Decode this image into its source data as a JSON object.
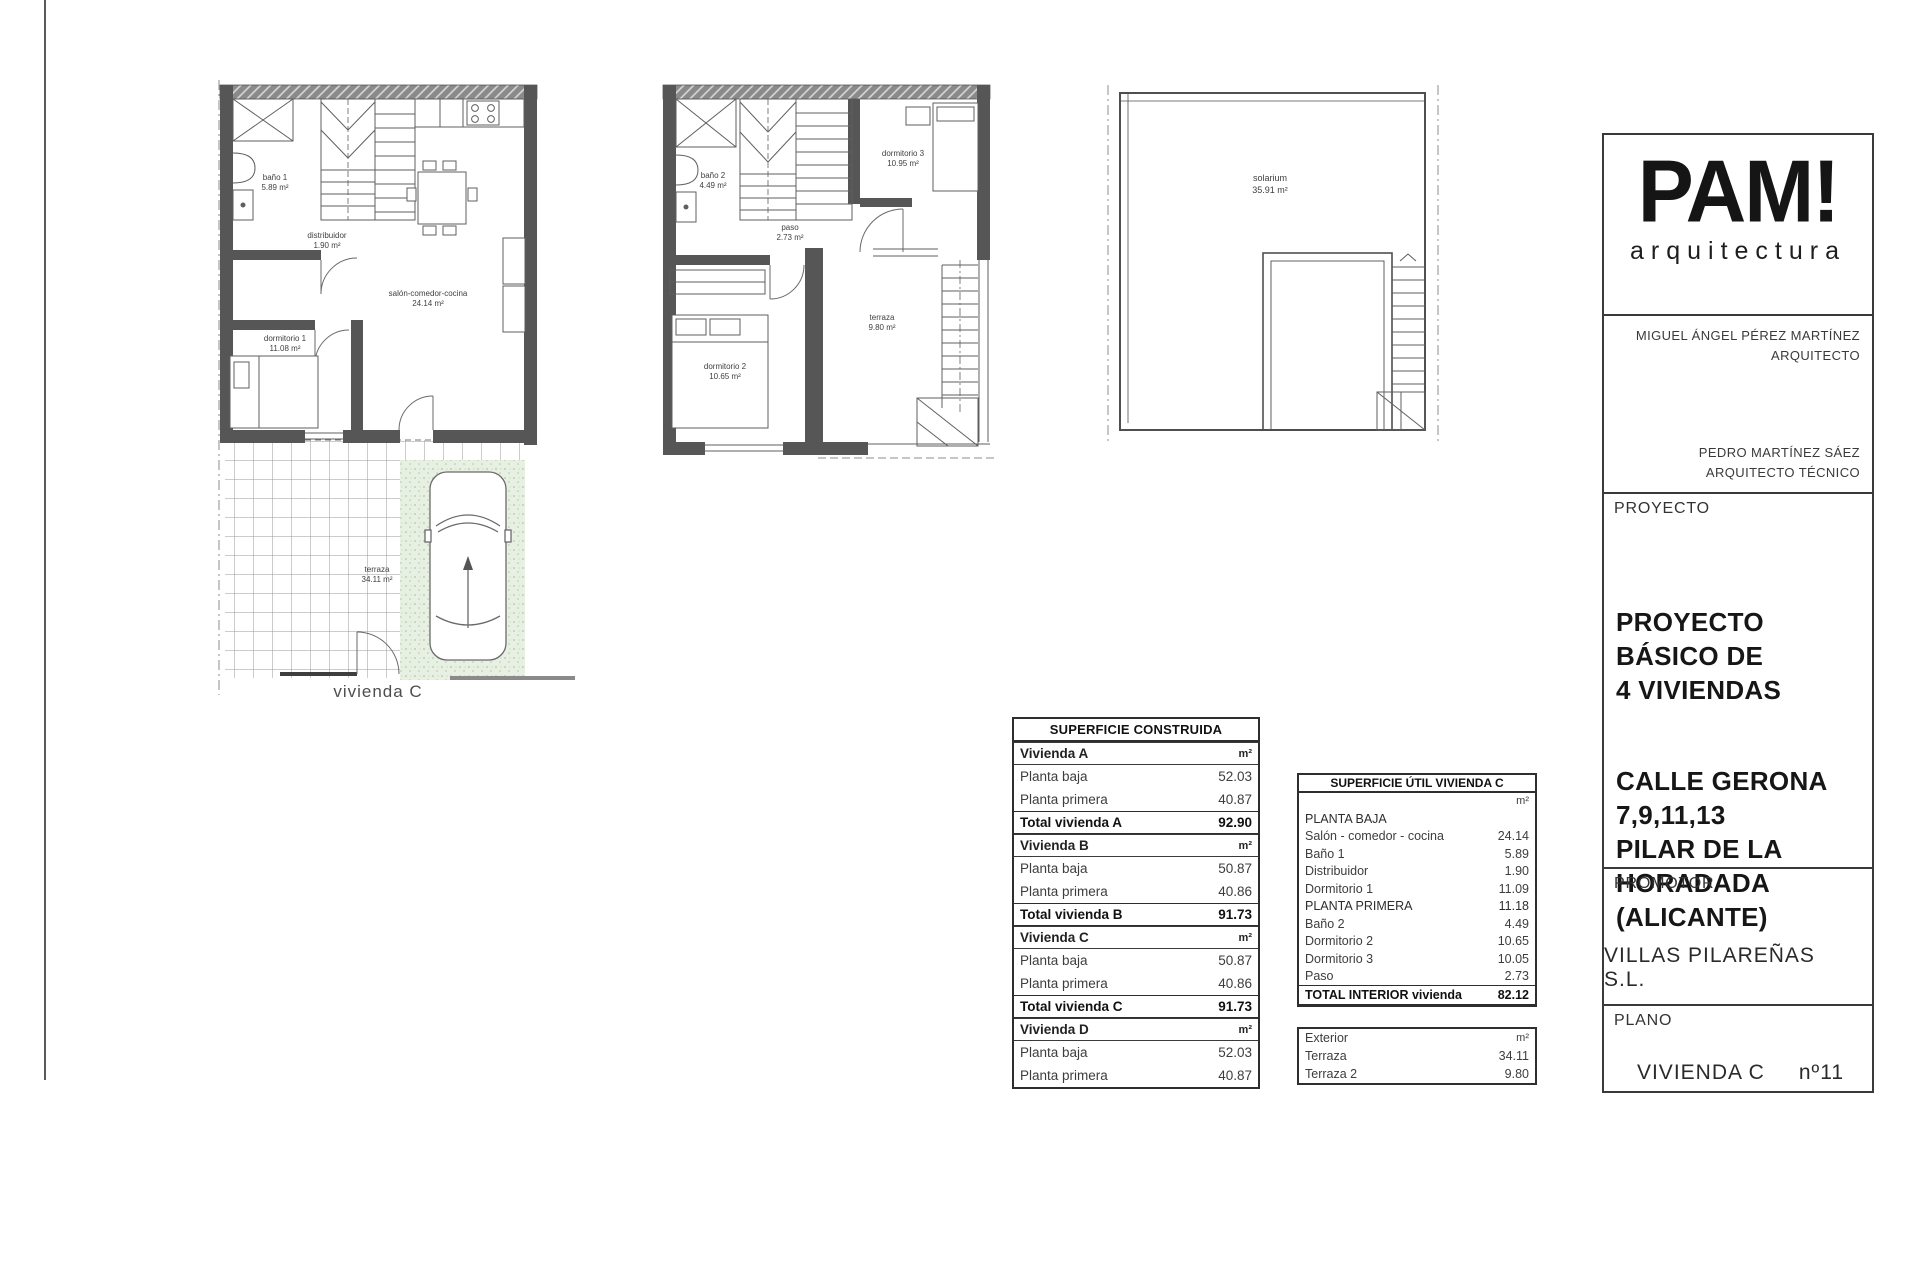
{
  "title_block": {
    "brand": "PAM!",
    "brand_subtitle": "arquitectura",
    "architect_name": "MIGUEL ÁNGEL PÉREZ MARTÍNEZ",
    "architect_role": "ARQUITECTO",
    "tech_architect_name": "PEDRO MARTÍNEZ SÁEZ",
    "tech_architect_role": "ARQUITECTO TÉCNICO",
    "proyecto_label": "PROYECTO",
    "proyecto_title": "PROYECTO BÁSICO DE\n4 VIVIENDAS",
    "proyecto_address": "CALLE GERONA\n7,9,11,13\nPILAR DE LA HORADADA\n(ALICANTE)",
    "promotor_label": "PROMOTOR",
    "promotor_name": "VILLAS PILAREÑAS S.L.",
    "plano_label": "PLANO",
    "plano_name": "VIVIENDA C",
    "plano_number": "nº11"
  },
  "plans": {
    "ground": {
      "caption": "vivienda C",
      "rooms": {
        "bano1": {
          "name": "baño 1",
          "area": "5.89 m²"
        },
        "distribuidor": {
          "name": "distribuidor",
          "area": "1.90 m²"
        },
        "salon": {
          "name": "salón-comedor-cocina",
          "area": "24.14 m²"
        },
        "dormitorio1": {
          "name": "dormitorio 1",
          "area": "11.08 m²"
        },
        "terraza": {
          "name": "terraza",
          "area": "34.11 m²"
        }
      }
    },
    "first": {
      "rooms": {
        "bano2": {
          "name": "baño 2",
          "area": "4.49 m²"
        },
        "dormitorio3": {
          "name": "dormitorio 3",
          "area": "10.95 m²"
        },
        "paso": {
          "name": "paso",
          "area": "2.73 m²"
        },
        "dormitorio2": {
          "name": "dormitorio 2",
          "area": "10.65 m²"
        },
        "terraza": {
          "name": "terraza",
          "area": "9.80 m²"
        }
      }
    },
    "solarium": {
      "rooms": {
        "solarium": {
          "name": "solarium",
          "area": "35.91 m²"
        }
      }
    }
  },
  "superficie_construida": {
    "title": "SUPERFICIE CONSTRUIDA",
    "rows": [
      {
        "label": "Vivienda A",
        "value": "m²",
        "type": "group"
      },
      {
        "label": "Planta baja",
        "value": "52.03",
        "type": "data"
      },
      {
        "label": "Planta primera",
        "value": "40.87",
        "type": "data"
      },
      {
        "label": "Total vivienda A",
        "value": "92.90",
        "type": "total"
      },
      {
        "label": "Vivienda B",
        "value": "m²",
        "type": "group"
      },
      {
        "label": "Planta baja",
        "value": "50.87",
        "type": "data"
      },
      {
        "label": "Planta primera",
        "value": "40.86",
        "type": "data"
      },
      {
        "label": "Total vivienda B",
        "value": "91.73",
        "type": "total"
      },
      {
        "label": "Vivienda C",
        "value": "m²",
        "type": "group"
      },
      {
        "label": "Planta baja",
        "value": "50.87",
        "type": "data"
      },
      {
        "label": "Planta primera",
        "value": "40.86",
        "type": "data"
      },
      {
        "label": "Total vivienda C",
        "value": "91.73",
        "type": "total"
      },
      {
        "label": "Vivienda D",
        "value": "m²",
        "type": "group"
      },
      {
        "label": "Planta baja",
        "value": "52.03",
        "type": "data"
      },
      {
        "label": "Planta primera",
        "value": "40.87",
        "type": "data"
      }
    ]
  },
  "superficie_util": {
    "title": "SUPERFICIE ÚTIL VIVIENDA C",
    "unit": "m²",
    "rows": [
      {
        "label": "PLANTA BAJA",
        "value": ""
      },
      {
        "label": "Salón - comedor - cocina",
        "value": "24.14"
      },
      {
        "label": "Baño 1",
        "value": "5.89"
      },
      {
        "label": "Distribuidor",
        "value": "1.90"
      },
      {
        "label": "Dormitorio 1",
        "value": "11.09"
      },
      {
        "label": "PLANTA PRIMERA",
        "value": "11.18"
      },
      {
        "label": "Baño 2",
        "value": "4.49"
      },
      {
        "label": "Dormitorio 2",
        "value": "10.65"
      },
      {
        "label": "Dormitorio 3",
        "value": "10.05"
      },
      {
        "label": "Paso",
        "value": "2.73"
      }
    ],
    "total_label": "TOTAL INTERIOR vivienda",
    "total_value": "82.12",
    "exterior_label": "Exterior",
    "exterior_unit": "m²",
    "exterior_rows": [
      {
        "label": "Terraza",
        "value": "34.11"
      },
      {
        "label": "Terraza 2",
        "value": "9.80"
      }
    ]
  },
  "colors": {
    "wall": "#565656",
    "driveway_green": "#e7f0e2",
    "line": "#5f5f5f"
  }
}
